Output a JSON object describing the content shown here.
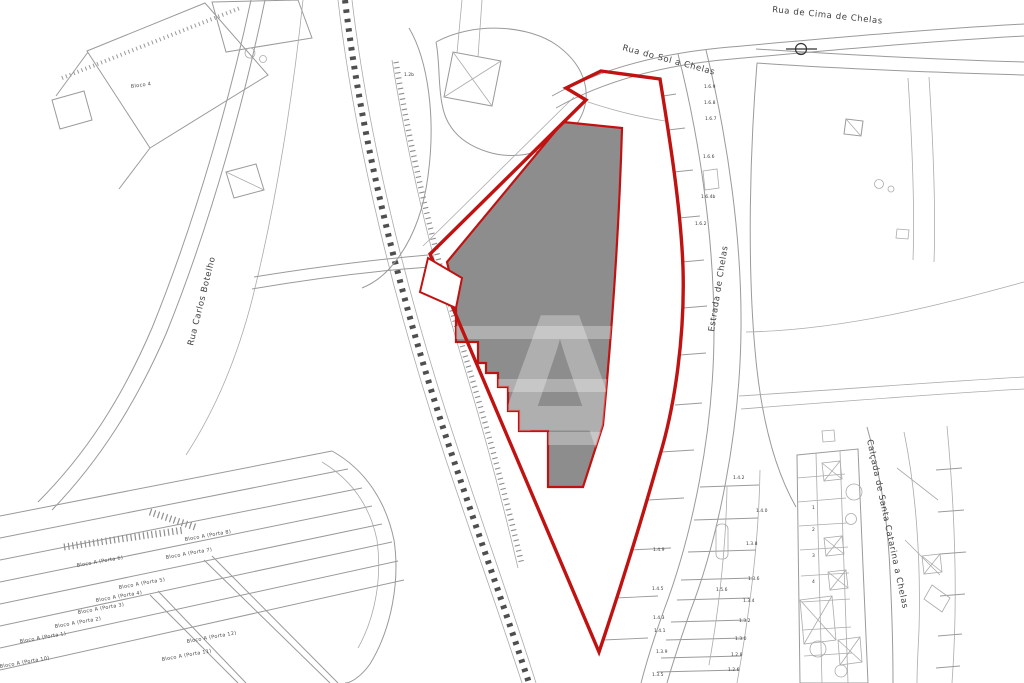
{
  "map": {
    "watermark_letter": "A",
    "colors": {
      "parcel_red": "#c11212",
      "building_gray": "#8d8d8d",
      "watermark_white": "rgba(255,255,255,0.30)",
      "linework_gray": "#9a9a9a",
      "rail_dark": "#4f4f4f"
    },
    "text_layers": [
      {
        "group": "street-labels",
        "class": "street",
        "item_name": "street-label",
        "items": [
          {
            "text": "Rua do Sol a Chelas",
            "x": 622,
            "y": 50,
            "r": 15,
            "size": 9
          },
          {
            "text": "Rua de Cima de Chelas",
            "x": 772,
            "y": 12,
            "r": 6,
            "size": 8.5
          },
          {
            "text": "Estrada de Chelas",
            "x": 714,
            "y": 332,
            "r": -81,
            "size": 8
          },
          {
            "text": "Rua Carlos Botelho",
            "x": 193,
            "y": 346,
            "r": -76,
            "size": 7.5
          },
          {
            "text": "Calçada de Santa Catarina a Chelas",
            "x": 867,
            "y": 440,
            "r": 78,
            "size": 8
          }
        ]
      },
      {
        "group": "block-labels",
        "class": "block",
        "item_name": "block-label",
        "items": [
          {
            "text": "Bloco A (Porta 8)",
            "x": 185,
            "y": 541,
            "r": -10
          },
          {
            "text": "Bloco A (Porta 7)",
            "x": 166,
            "y": 559,
            "r": -10
          },
          {
            "text": "Bloco A (Porta 6)",
            "x": 77,
            "y": 567,
            "r": -10
          },
          {
            "text": "Bloco A (Porta 5)",
            "x": 119,
            "y": 589,
            "r": -10
          },
          {
            "text": "Bloco A (Porta 4)",
            "x": 96,
            "y": 602,
            "r": -10
          },
          {
            "text": "Bloco A (Porta 3)",
            "x": 78,
            "y": 614,
            "r": -10
          },
          {
            "text": "Bloco A (Porta 2)",
            "x": 55,
            "y": 628,
            "r": -10
          },
          {
            "text": "Bloco A (Porta 1)",
            "x": 20,
            "y": 643,
            "r": -10
          },
          {
            "text": "Bloco A (Porta 12)",
            "x": 187,
            "y": 643,
            "r": -10
          },
          {
            "text": "Bloco A (Porta 11)",
            "x": 162,
            "y": 661,
            "r": -10
          },
          {
            "text": "Bloco A (Porta 10)",
            "x": 0,
            "y": 668,
            "r": -10
          },
          {
            "text": "Bloco 4",
            "x": 131,
            "y": 88,
            "r": -8
          }
        ]
      },
      {
        "group": "lot-numbers",
        "class": "lot",
        "item_name": "lot-number",
        "items": [
          {
            "text": "1.6.9",
            "x": 704,
            "y": 88
          },
          {
            "text": "1.6.8",
            "x": 704,
            "y": 104
          },
          {
            "text": "1.6.7",
            "x": 705,
            "y": 120
          },
          {
            "text": "1.6.6",
            "x": 703,
            "y": 158
          },
          {
            "text": "1.6.4b",
            "x": 701,
            "y": 198
          },
          {
            "text": "1.6.2",
            "x": 695,
            "y": 225
          },
          {
            "text": "1.2b",
            "x": 404,
            "y": 76
          },
          {
            "text": "1.4.9",
            "x": 653,
            "y": 551
          },
          {
            "text": "1.4.5",
            "x": 652,
            "y": 590
          },
          {
            "text": "1.4.3",
            "x": 653,
            "y": 619
          },
          {
            "text": "1.4.1",
            "x": 654,
            "y": 632
          },
          {
            "text": "1.3.9",
            "x": 656,
            "y": 653
          },
          {
            "text": "1.3.5",
            "x": 652,
            "y": 676
          },
          {
            "text": "1.4.2",
            "x": 733,
            "y": 479
          },
          {
            "text": "1.4.0",
            "x": 756,
            "y": 512
          },
          {
            "text": "1.3.8",
            "x": 746,
            "y": 545
          },
          {
            "text": "1.3.6",
            "x": 748,
            "y": 580
          },
          {
            "text": "1.5.6",
            "x": 716,
            "y": 591
          },
          {
            "text": "1.3.4",
            "x": 743,
            "y": 602
          },
          {
            "text": "1.3.2",
            "x": 739,
            "y": 622
          },
          {
            "text": "1.3.0",
            "x": 735,
            "y": 640
          },
          {
            "text": "1.2.8",
            "x": 731,
            "y": 656
          },
          {
            "text": "1.2.6",
            "x": 728,
            "y": 671
          },
          {
            "text": "1",
            "x": 812,
            "y": 509
          },
          {
            "text": "2",
            "x": 812,
            "y": 531
          },
          {
            "text": "3",
            "x": 812,
            "y": 557
          },
          {
            "text": "4",
            "x": 812,
            "y": 583
          }
        ]
      }
    ]
  }
}
